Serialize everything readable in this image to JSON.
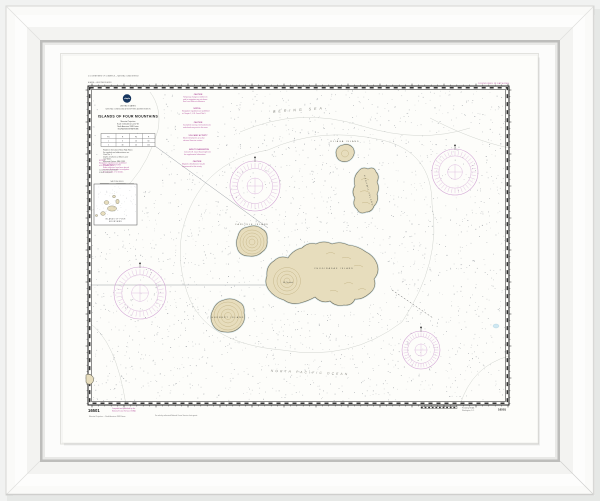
{
  "chart": {
    "number": "16501",
    "colors": {
      "accent_magenta": "#b4559f",
      "land_tan": "#e7ddbd",
      "logo_navy": "#16355e"
    },
    "top": {
      "line1": "U.S. DEPARTMENT OF COMMERCE — NATIONAL OCEAN SERVICE",
      "line2": "ALASKA — ALEUTIAN ISLANDS",
      "right_note": "SOUNDINGS IN FATHOMS"
    },
    "titleblock": {
      "agency_small": "UNITED STATES",
      "agency_line2": "NATIONAL OCEANIC AND ATMOSPHERIC ADMINISTRATION",
      "title": "ISLANDS OF FOUR MOUNTAINS",
      "sub_lines": [
        "Mercator Projection",
        "Scale 1:100,000 at Lat 52°50'",
        "North American 1983 Datum",
        "SOUNDINGS IN FATHOMS"
      ],
      "table": {
        "cols": [
          "Fm",
          "Ft",
          "Fm",
          "Ft"
        ],
        "rows": [
          [
            "1",
            "6",
            "10",
            "60"
          ],
          [
            "5",
            "30",
            "20",
            "120"
          ]
        ]
      },
      "paragraph": [
        "Heights in feet above Mean High Water.",
        "For symbols and abbreviations see",
        "Chart No. 1.",
        "Depths in fathoms at Mean Lower",
        "Low Water.",
        "Horizontal Datum: NAD 1983."
      ],
      "magenta_note": [
        "RADAR REFLECTORS",
        "Radar reflectors have been placed",
        "on many floating aids to navigation.",
        "See Chart No. 1 for details."
      ],
      "scale_label": "NAUTICAL MILES"
    },
    "inset": {
      "magenta_note": [
        "NOTE B",
        "Navigation regulations are published",
        "in U.S. Coast Pilot 9."
      ],
      "black_note": [
        "Continued on Chart 16500",
        "SCALE 1:400,000"
      ],
      "label_lines": [
        "ISLANDS OF FOUR",
        "MOUNTAINS"
      ]
    },
    "seas": {
      "top": "BERING SEA",
      "bottom": "NORTH PACIFIC OCEAN"
    },
    "islands": [
      {
        "name": "ULIAGA ISLAND",
        "x": 345,
        "y": 142,
        "rot": 0,
        "small": false
      },
      {
        "name": "KAGAMIL ISLAND",
        "x": 368,
        "y": 191,
        "rot": 75,
        "small": false
      },
      {
        "name": "CARLISLE ISLAND",
        "x": 252,
        "y": 225,
        "rot": 0,
        "small": false
      },
      {
        "name": "CHUGINADAK ISLAND",
        "x": 334,
        "y": 269,
        "rot": 0,
        "small": false
      },
      {
        "name": "Mt. Cleveland",
        "x": 288,
        "y": 283,
        "rot": 0,
        "small": true
      },
      {
        "name": "HERBERT ISLAND",
        "x": 228,
        "y": 318,
        "rot": 0,
        "small": false
      }
    ],
    "notes": [
      {
        "title": "CAUTION",
        "lines": [
          "Temporary changes or defects in",
          "aids to navigation are not shown.",
          "See Local Notice to Mariners."
        ]
      },
      {
        "title": "NOTE A",
        "lines": [
          "Navigation regulations are published",
          "in Chapter 2, U.S. Coast Pilot 9."
        ]
      },
      {
        "title": "CAUTION",
        "lines": [
          "Incomplete surveys. Uncharted rocks",
          "and shoals may exist in this area."
        ]
      },
      {
        "title": "VOLCANIC ACTIVITY",
        "lines": [
          "Mount Cleveland is an active",
          "volcano. Exercise caution."
        ]
      },
      {
        "title": "AIDS TO NAVIGATION",
        "lines": [
          "Consult U.S. Coast Guard Light List",
          "for supplemental information."
        ]
      },
      {
        "title": "CAUTION",
        "lines": [
          "Magnetic disturbances may be",
          "experienced in this vicinity."
        ]
      }
    ],
    "bottom": {
      "number": "16501",
      "magenta_lines": [
        "Compiled and published by the",
        "National Ocean Service, NOAA"
      ],
      "projection_note": "Mercator Projection — North American 1983 Datum",
      "agents_note": "For sale by authorized National Ocean Service chart agents.",
      "right_lines": [
        "Printed by NOAA",
        "Washington, D.C."
      ]
    }
  }
}
